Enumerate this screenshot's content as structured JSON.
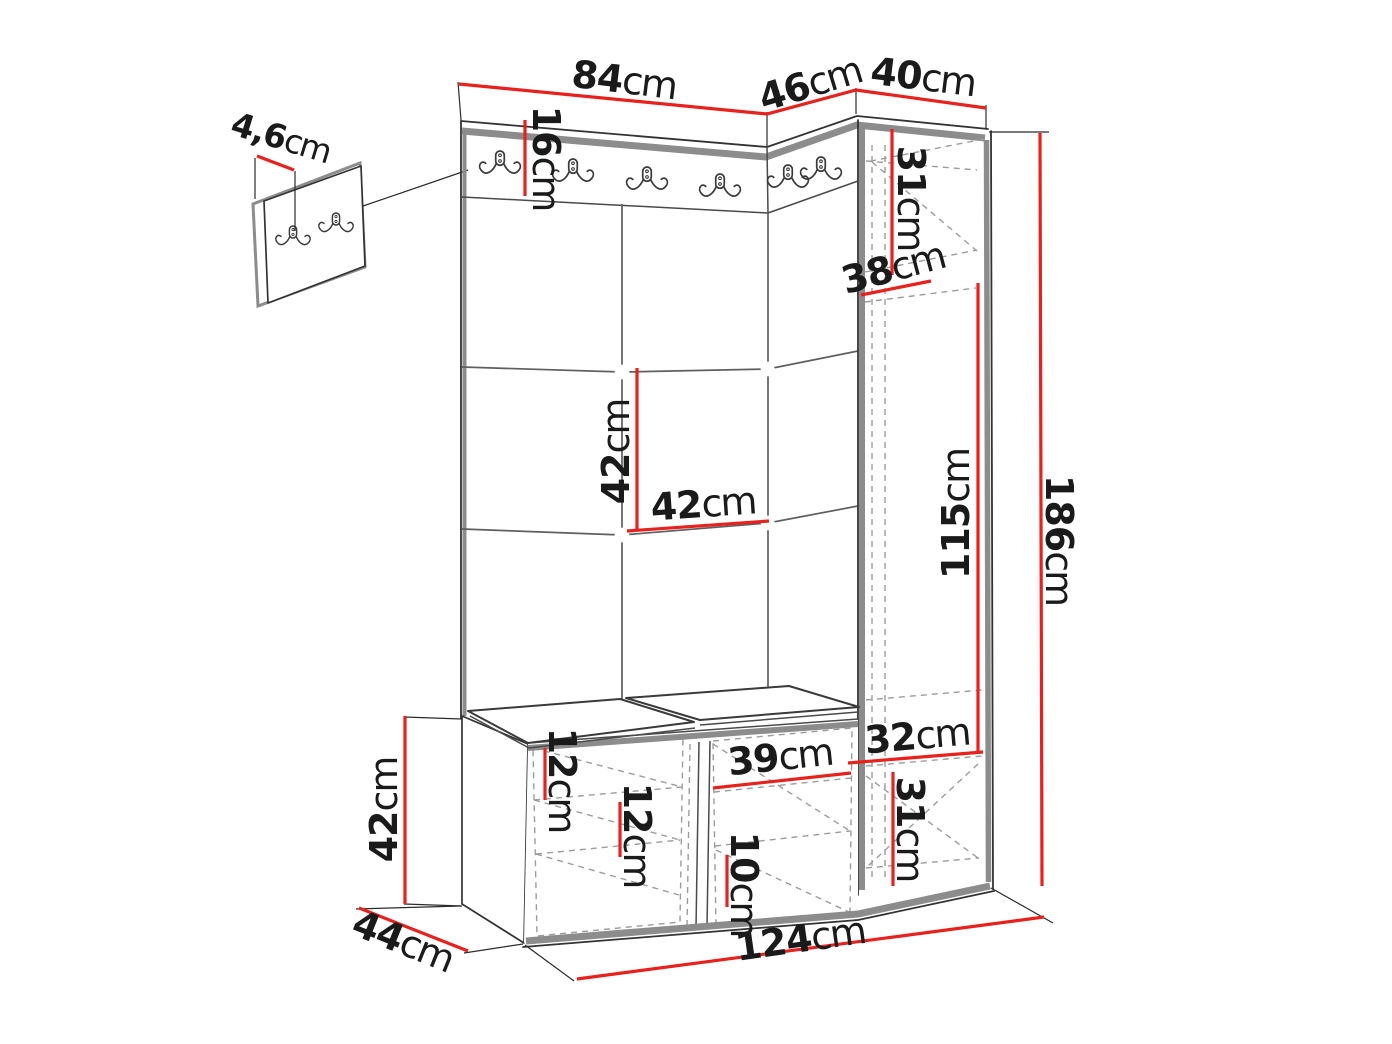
{
  "colors": {
    "dimension_line": "#e8211c",
    "outline": "#333333",
    "panel_edge": "#8c8c8c",
    "hidden_line": "#9c9c9c",
    "label_text": "#1a1a1a",
    "background": "#ffffff"
  },
  "icons": {
    "double_hook": "double-coat-hook-icon"
  },
  "dimensions": {
    "wall_panel_width": {
      "num": "4,6",
      "unit": "cm"
    },
    "main_section_width": {
      "num": "84",
      "unit": "cm"
    },
    "corner_section_width": {
      "num": "46",
      "unit": "cm"
    },
    "cabinet_width": {
      "num": "40",
      "unit": "cm"
    },
    "rail_height": {
      "num": "16",
      "unit": "cm"
    },
    "cabinet_top_height": {
      "num": "31",
      "unit": "cm"
    },
    "cabinet_depth": {
      "num": "38",
      "unit": "cm"
    },
    "tile_height": {
      "num": "42",
      "unit": "cm"
    },
    "tile_width": {
      "num": "42",
      "unit": "cm"
    },
    "door_height": {
      "num": "115",
      "unit": "cm"
    },
    "total_height": {
      "num": "186",
      "unit": "cm"
    },
    "bench_height": {
      "num": "42",
      "unit": "cm"
    },
    "bench_depth": {
      "num": "44",
      "unit": "cm"
    },
    "shelf_gap_upper": {
      "num": "12",
      "unit": "cm"
    },
    "shelf_gap_lower": {
      "num": "12",
      "unit": "cm"
    },
    "bench_compartment_width": {
      "num": "39",
      "unit": "cm"
    },
    "shelf_gap_bottom": {
      "num": "10",
      "unit": "cm"
    },
    "cabinet_bottom_width": {
      "num": "32",
      "unit": "cm"
    },
    "cabinet_bottom_height": {
      "num": "31",
      "unit": "cm"
    },
    "total_width": {
      "num": "124",
      "unit": "cm"
    }
  }
}
